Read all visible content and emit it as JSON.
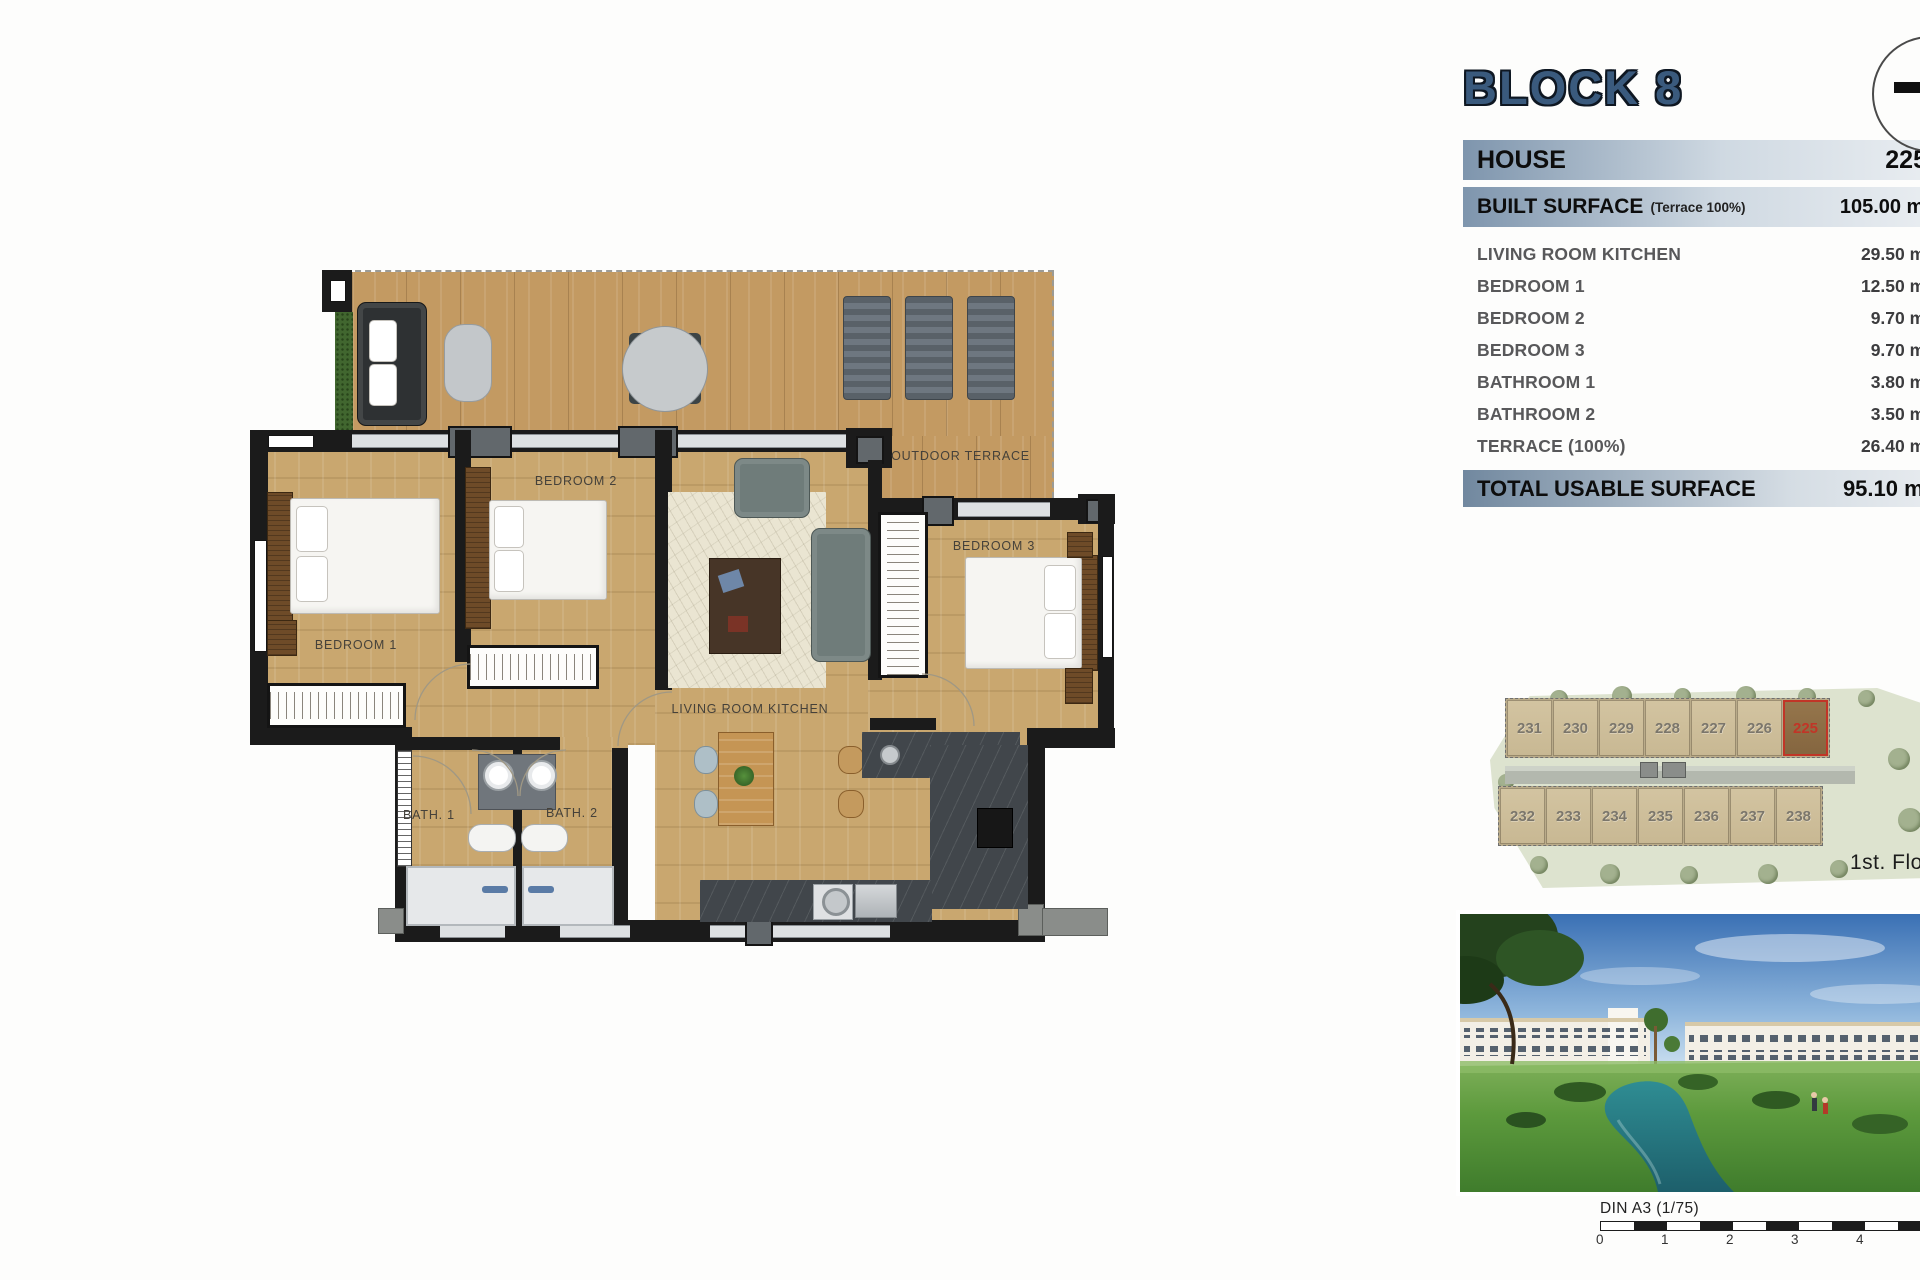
{
  "summary_panel": {
    "title": "BLOCK 8",
    "house": {
      "label": "HOUSE",
      "value": "225"
    },
    "built_surface": {
      "label": "BUILT SURFACE",
      "note": "(Terrace 100%)",
      "value": "105.00 m²"
    },
    "rooms": [
      {
        "label": "LIVING ROOM KITCHEN",
        "value": "29.50 m²"
      },
      {
        "label": "BEDROOM 1",
        "value": "12.50 m²"
      },
      {
        "label": "BEDROOM 2",
        "value": "9.70 m²"
      },
      {
        "label": "BEDROOM 3",
        "value": "9.70 m²"
      },
      {
        "label": "BATHROOM 1",
        "value": "3.80 m²"
      },
      {
        "label": "BATHROOM 2",
        "value": "3.50 m²"
      },
      {
        "label": "TERRACE (100%)",
        "value": "26.40 m²"
      }
    ],
    "total": {
      "label": "TOTAL USABLE SURFACE",
      "value": "95.10 m²"
    }
  },
  "floor_plan": {
    "labels": {
      "bedroom1": "BEDROOM 1",
      "bedroom2": "BEDROOM 2",
      "bedroom3": "BEDROOM 3",
      "living": "LIVING ROOM KITCHEN",
      "bath1": "BATH. 1",
      "bath2": "BATH. 2",
      "terrace": "OUTDOOR TERRACE"
    }
  },
  "site_plan": {
    "floor_label": "1st. Floor",
    "top_row_units": [
      "231",
      "230",
      "229",
      "228",
      "227",
      "226",
      "225"
    ],
    "bottom_row_units": [
      "232",
      "233",
      "234",
      "235",
      "236",
      "237",
      "238"
    ],
    "highlighted_unit": "225"
  },
  "scale_bar": {
    "label": "DIN A3 (1/75)",
    "ticks": [
      "0",
      "1",
      "2",
      "3",
      "4"
    ]
  },
  "colors": {
    "accent_blue": "#3a5a7d",
    "bar_gradient_start": "#7e95ad",
    "bar_gradient_end": "#e9edf1",
    "highlight_red": "#c13527",
    "wood": "#c9a76f",
    "wall": "#1b1b1b",
    "site_green": "#dde3cf"
  }
}
